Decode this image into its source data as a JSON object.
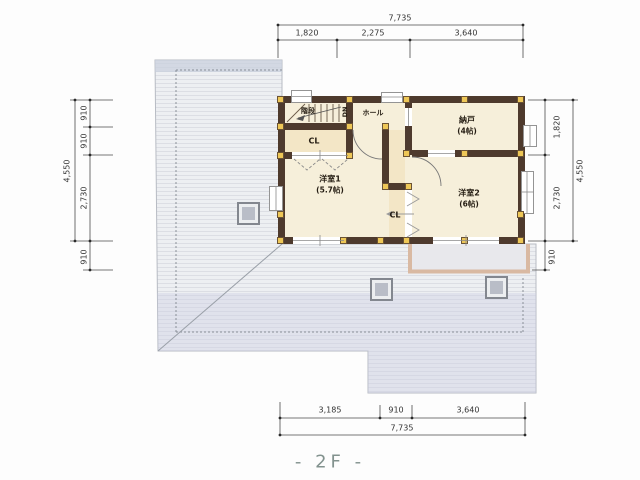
{
  "floor_label": "- 2F -",
  "rooms": {
    "stairs": {
      "label": "階段"
    },
    "stairs_dn": {
      "label": "DN"
    },
    "hall": {
      "label": "ホール"
    },
    "storage": {
      "label": "納戸",
      "size": "(4帖)"
    },
    "closet_upper": {
      "label": "CL"
    },
    "western_room_1": {
      "label": "洋室1",
      "size": "(5.7帖)"
    },
    "closet_middle": {
      "label": "CL"
    },
    "western_room_2": {
      "label": "洋室2",
      "size": "(6帖)"
    }
  },
  "dimensions": {
    "top": {
      "total": "7,735",
      "segments": [
        "1,820",
        "2,275",
        "3,640"
      ]
    },
    "bottom": {
      "total": "7,735",
      "segments": [
        "3,185",
        "910",
        "3,640"
      ]
    },
    "left": {
      "total": "4,550",
      "segments": [
        "910",
        "910",
        "2,730"
      ],
      "below": "910"
    },
    "right": {
      "total": "4,550",
      "segments": [
        "1,820",
        "2,730"
      ],
      "below": "910"
    }
  },
  "colors": {
    "wall": "#4e3a2d",
    "post": "#eec757",
    "floor": "#f6efda",
    "roof": "#e9ebee",
    "balcony_edge": "#d9b9a2",
    "floor_label_color": "#82928e"
  }
}
